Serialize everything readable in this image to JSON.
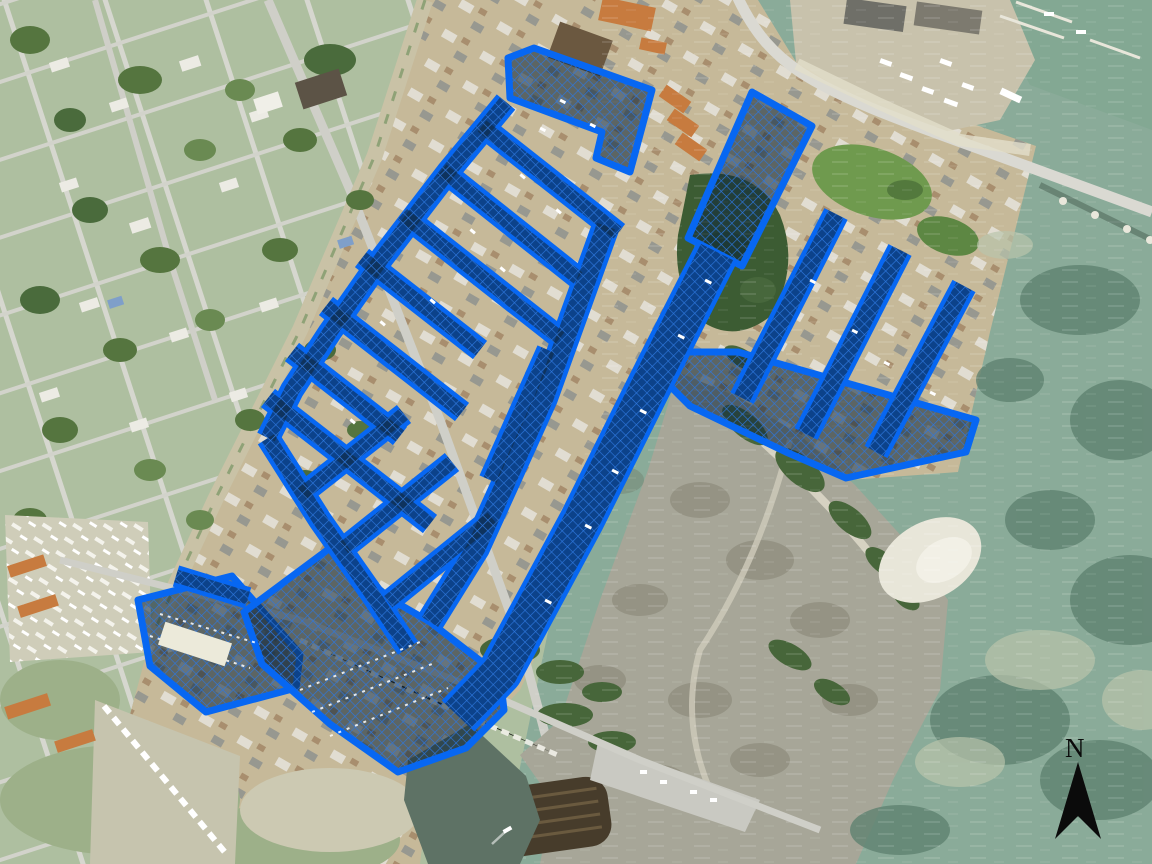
{
  "map": {
    "type": "aerial-satellite-imagery-with-gis-overlay",
    "north_arrow": {
      "label": "N"
    },
    "overlay": {
      "name": "canal-water-parcels-hatched-overlay",
      "pattern": "diagonal-crosshatch",
      "outline_color": "#0767f2",
      "hatch_line": "#2e77dd",
      "hatch_fill": "rgba(15,40,62,0.58)"
    },
    "colors": {
      "old_town_land": "#aebfa0",
      "subdivision_land": "#c6b999",
      "bay_water": "#8aab99",
      "bay_water_deep": "#5f8270",
      "ne_corner_water": "#83a893",
      "shoal_light": "#b9c4ab",
      "marsh_flat": "#a7a698",
      "shrub_green": "#47663a",
      "woods_green": "#3c5c33",
      "sand_white": "#e8e6d9",
      "road_gray": "#cfcfc8",
      "highway_gray": "#dad9d2",
      "cove_water": "#5e7265",
      "arrow_black": "#0b0b0b"
    }
  }
}
